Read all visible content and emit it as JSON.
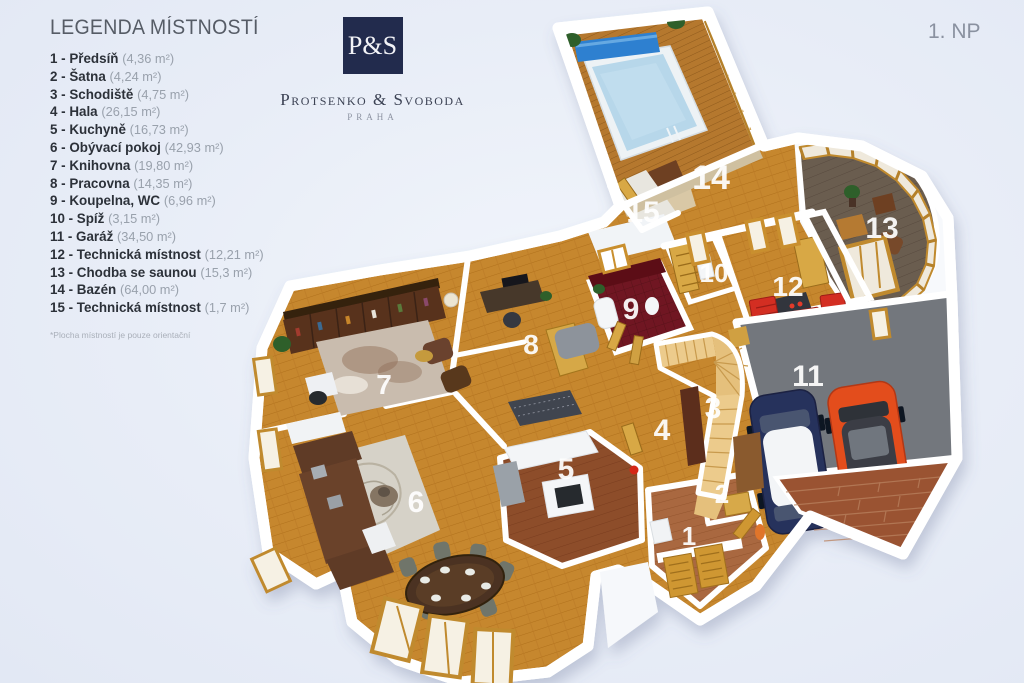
{
  "header": {
    "floor_label": "1. NP"
  },
  "logo": {
    "monogram": "P&S",
    "name": "Protsenko & Svoboda",
    "city": "PRAHA"
  },
  "legend": {
    "title": "LEGENDA MÍSTNOSTÍ",
    "footnote": "*Plocha místností je pouze orientační",
    "items": [
      {
        "number": "1",
        "name": "Předsíň",
        "area": "(4,36 m²)"
      },
      {
        "number": "2",
        "name": "Šatna",
        "area": "(4,24 m²)"
      },
      {
        "number": "3",
        "name": "Schodiště",
        "area": "(4,75 m²)"
      },
      {
        "number": "4",
        "name": "Hala",
        "area": "(26,15 m²)"
      },
      {
        "number": "5",
        "name": "Kuchyně",
        "area": "(16,73 m²)"
      },
      {
        "number": "6",
        "name": "Obývací pokoj",
        "area": "(42,93 m²)"
      },
      {
        "number": "7",
        "name": "Knihovna",
        "area": "(19,80 m²)"
      },
      {
        "number": "8",
        "name": "Pracovna",
        "area": "(14,35 m²)"
      },
      {
        "number": "9",
        "name": "Koupelna, WC",
        "area": "(6,96 m²)"
      },
      {
        "number": "10",
        "name": "Spíž",
        "area": "(3,15 m²)"
      },
      {
        "number": "11",
        "name": "Garáž",
        "area": "(34,50 m²)"
      },
      {
        "number": "12",
        "name": "Technická místnost",
        "area": "(12,21 m²)"
      },
      {
        "number": "13",
        "name": "Chodba se saunou",
        "area": "(15,3 m²)"
      },
      {
        "number": "14",
        "name": "Bazén",
        "area": "(64,00 m²)"
      },
      {
        "number": "15",
        "name": "Technická místnost",
        "area": "(1,7 m²)"
      }
    ]
  },
  "palette": {
    "background": "#e8edf7",
    "wall": "#ffffff",
    "parquet": "#c6872f",
    "deck": "#b5782e",
    "kitchen_floor": "#8d4d2a",
    "garage_floor": "#73777d",
    "bathroom_floor": "#6f1822",
    "corridor13_floor": "#6b5d50",
    "pool_water": "#b7d7ea",
    "pool_cover": "#2f80d0",
    "wood_trim": "#c98f2e",
    "red_cabinet": "#d32f23",
    "car_navy": "#27305c",
    "car_orange": "#e34d1e",
    "brick": "#9a5233",
    "logo_navy": "#222b4d"
  }
}
